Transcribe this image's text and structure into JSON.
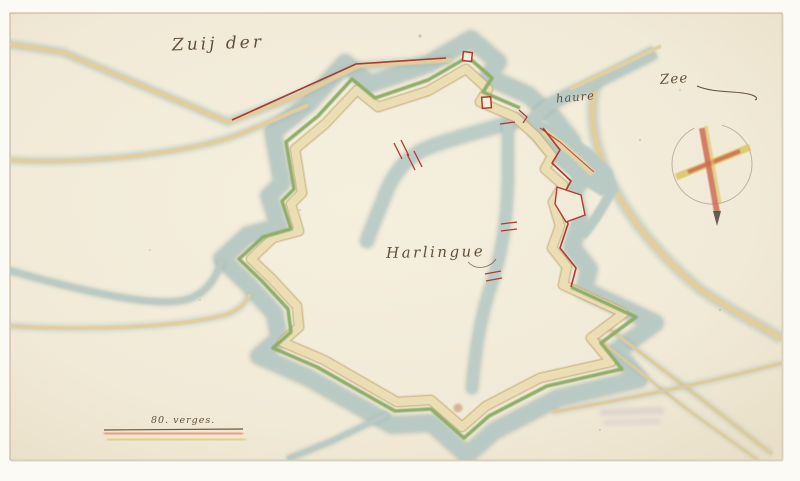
{
  "map": {
    "labels": {
      "sea1": "Zuij der",
      "sea2": "Zee",
      "harbor": "haure",
      "city": "Harlingue",
      "scale": "80. verges."
    },
    "icons": {
      "compass": "compass-cross-icon"
    },
    "colors": {
      "paper": "#f2ebd9",
      "mat": "#fbfaf4",
      "water": "#b9cac5",
      "water_edge": "#8fa6a2",
      "rampart_green": "#8fae6b",
      "rampart_sand": "#e7d7ab",
      "road_sand": "#e2cd9d",
      "red_ink": "#b03a2e",
      "writing_ink": "#63503a",
      "compass_yellow": "#d9c35b",
      "compass_red": "#cf6a55",
      "scale_red": "#ef8d72",
      "scale_yellow": "#d9c455"
    }
  }
}
